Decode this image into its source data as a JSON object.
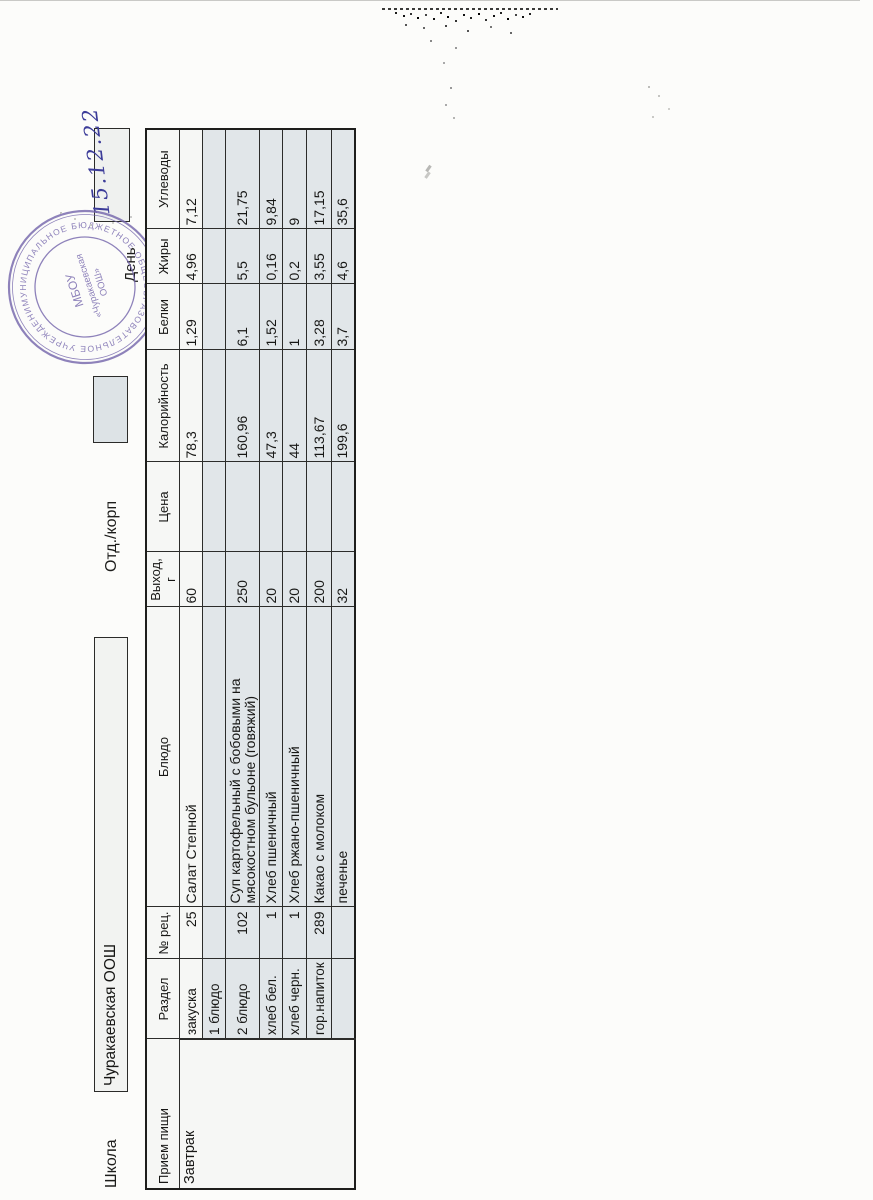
{
  "header": {
    "school_label": "Школа",
    "school_name": "Чуракаевская ООШ",
    "dept_label": "Отд./корп",
    "day_label": "День",
    "handwritten_date": "15.12.22"
  },
  "stamp": {
    "ring_text": "МУНИЦИПАЛЬНОЕ БЮДЖЕТНОЕ ОБЩЕОБРАЗОВАТЕЛЬНОЕ УЧРЕЖДЕНИЕ • ОГРН •",
    "center_line1": "МБОУ",
    "center_line2": "«Чуракаевская",
    "center_line3": "ООШ»",
    "color": "#7668ad"
  },
  "colors": {
    "paper": "#fcfcfa",
    "cell_gray": "#e1e6e9",
    "cell_white": "#f6f7f5",
    "ink": "#171715",
    "handwriting_ink": "#3c3c99"
  },
  "table": {
    "columns": [
      "Прием пищи",
      "Раздел",
      "№ рец.",
      "Блюдо",
      "Выход, г",
      "Цена",
      "Калорийность",
      "Белки",
      "Жиры",
      "Углеводы"
    ],
    "meal_type": "Завтрак",
    "rows": [
      {
        "razdel": "закуска",
        "num": "25",
        "dish": "Салат Степной",
        "out": "60",
        "price": "",
        "kcal": "78,3",
        "protein": "1,29",
        "fat": "4,96",
        "carbs": "7,12"
      },
      {
        "razdel": "1 блюдо",
        "num": "",
        "dish": "",
        "out": "",
        "price": "",
        "kcal": "",
        "protein": "",
        "fat": "",
        "carbs": ""
      },
      {
        "razdel": "2 блюдо",
        "num": "102",
        "dish": "Суп картофельный с бобовыми на мясокостном бульоне (говяжий)",
        "out": "250",
        "price": "",
        "kcal": "160,96",
        "protein": "6,1",
        "fat": "5,5",
        "carbs": "21,75"
      },
      {
        "razdel": "хлеб бел.",
        "num": "1",
        "dish": "Хлеб пшеничный",
        "out": "20",
        "price": "",
        "kcal": "47,3",
        "protein": "1,52",
        "fat": "0,16",
        "carbs": "9,84"
      },
      {
        "razdel": "хлеб черн.",
        "num": "1",
        "dish": "Хлеб ржано-пшеничный",
        "out": "20",
        "price": "",
        "kcal": "44",
        "protein": "1",
        "fat": "0,2",
        "carbs": "9"
      },
      {
        "razdel": "гор.напиток",
        "num": "289",
        "dish": "Какао с молоком",
        "out": "200",
        "price": "",
        "kcal": "113,67",
        "protein": "3,28",
        "fat": "3,55",
        "carbs": "17,15"
      },
      {
        "razdel": "",
        "num": "",
        "dish": "печенье",
        "out": "32",
        "price": "",
        "kcal": "199,6",
        "protein": "3,7",
        "fat": "4,6",
        "carbs": "35,6"
      }
    ]
  }
}
